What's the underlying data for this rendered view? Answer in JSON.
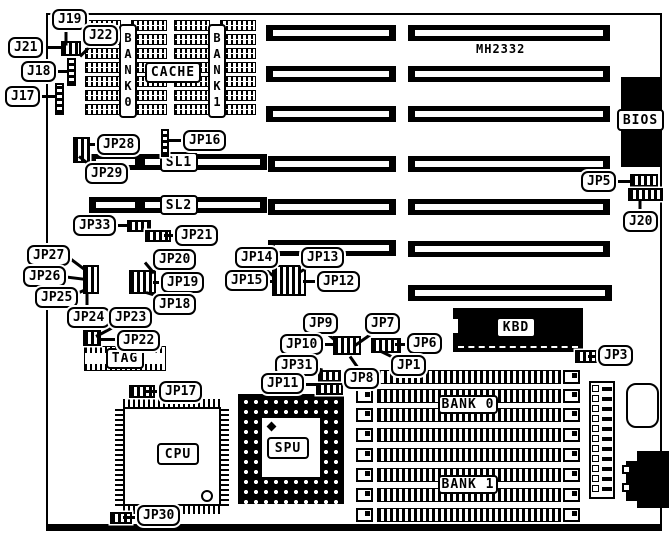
{
  "board_name": "MH2332",
  "chip_text": {
    "mh2332": "MH2332",
    "bios": "BIOS",
    "kbd": "KBD",
    "cpu": "CPU",
    "pga": "SPU",
    "tag": "TAG",
    "cache": "CACHE",
    "cache_bank0": "BANK0",
    "cache_bank1": "BANK1",
    "sl1": "SL1",
    "sl2": "SL2",
    "simm_bank0": "BANK 0",
    "simm_bank1": "BANK 1"
  },
  "callouts": [
    {
      "label": "J19",
      "x": 52,
      "y": 9,
      "tail": [
        66,
        28,
        16,
        90
      ]
    },
    {
      "label": "J21",
      "x": 8,
      "y": 37,
      "tail": [
        47,
        46,
        16,
        0
      ]
    },
    {
      "label": "J22",
      "x": 83,
      "y": 25,
      "tail": [
        90,
        45,
        14,
        135
      ]
    },
    {
      "label": "J18",
      "x": 21,
      "y": 61,
      "tail": [
        56,
        70,
        13,
        0
      ]
    },
    {
      "label": "J17",
      "x": 5,
      "y": 86,
      "tail": [
        42,
        95,
        15,
        0
      ]
    },
    {
      "label": "JP28",
      "x": 97,
      "y": 134,
      "tail": [
        88,
        143,
        11,
        0
      ]
    },
    {
      "label": "JP29",
      "x": 85,
      "y": 163,
      "tail": [
        79,
        155,
        13,
        38
      ]
    },
    {
      "label": "JP16",
      "x": 183,
      "y": 130,
      "tail": [
        168,
        139,
        16,
        0
      ]
    },
    {
      "label": "JP33",
      "x": 73,
      "y": 215,
      "tail": [
        110,
        224,
        18,
        0
      ]
    },
    {
      "label": "JP21",
      "x": 175,
      "y": 225,
      "tail": [
        164,
        234,
        12,
        0
      ]
    },
    {
      "label": "JP27",
      "x": 27,
      "y": 245,
      "tail": [
        66,
        254,
        23,
        37
      ]
    },
    {
      "label": "JP26",
      "x": 23,
      "y": 266,
      "tail": [
        62,
        275,
        23,
        7
      ]
    },
    {
      "label": "JP25",
      "x": 35,
      "y": 287,
      "tail": [
        72,
        294,
        16,
        -23
      ]
    },
    {
      "label": "JP24",
      "x": 67,
      "y": 307,
      "tail": [
        87,
        292,
        16,
        90
      ]
    },
    {
      "label": "JP23",
      "x": 109,
      "y": 307,
      "tail": [
        96,
        335,
        19,
        -28
      ]
    },
    {
      "label": "JP22",
      "x": 117,
      "y": 330,
      "tail": [
        99,
        338,
        19,
        0
      ]
    },
    {
      "label": "JP20",
      "x": 153,
      "y": 249,
      "tail": [
        145,
        261,
        14,
        50
      ]
    },
    {
      "label": "JP19",
      "x": 161,
      "y": 272,
      "tail": [
        153,
        281,
        9,
        0
      ]
    },
    {
      "label": "JP18",
      "x": 153,
      "y": 294,
      "tail": [
        146,
        291,
        13,
        17
      ]
    },
    {
      "label": "JP14",
      "x": 235,
      "y": 247,
      "tail": [
        262,
        265,
        15,
        40
      ]
    },
    {
      "label": "JP13",
      "x": 301,
      "y": 247,
      "tail": [
        299,
        271,
        15,
        -30
      ]
    },
    {
      "label": "JP15",
      "x": 225,
      "y": 270,
      "tail": [
        260,
        280,
        13,
        0
      ]
    },
    {
      "label": "JP12",
      "x": 317,
      "y": 271,
      "tail": [
        303,
        280,
        15,
        0
      ]
    },
    {
      "label": "JP9",
      "x": 303,
      "y": 313,
      "tail": [
        327,
        332,
        13,
        40
      ]
    },
    {
      "label": "JP7",
      "x": 365,
      "y": 313,
      "tail": [
        355,
        344,
        20,
        -35
      ]
    },
    {
      "label": "JP10",
      "x": 280,
      "y": 334,
      "tail": [
        318,
        343,
        16,
        0
      ]
    },
    {
      "label": "JP6",
      "x": 407,
      "y": 333,
      "tail": [
        395,
        343,
        13,
        0
      ]
    },
    {
      "label": "JP31",
      "x": 275,
      "y": 355,
      "tail": [
        308,
        365,
        15,
        14
      ]
    },
    {
      "label": "JP1",
      "x": 391,
      "y": 355,
      "tail": [
        379,
        349,
        15,
        26
      ]
    },
    {
      "label": "JP8",
      "x": 344,
      "y": 368,
      "tail": [
        350,
        355,
        15,
        55
      ]
    },
    {
      "label": "JP11",
      "x": 261,
      "y": 373,
      "tail": [
        301,
        383,
        16,
        0
      ]
    },
    {
      "label": "JP3",
      "x": 598,
      "y": 345,
      "tail": [
        588,
        355,
        11,
        0
      ]
    },
    {
      "label": "JP5",
      "x": 581,
      "y": 171,
      "tail": [
        613,
        180,
        18,
        0
      ]
    },
    {
      "label": "J20",
      "x": 623,
      "y": 211,
      "tail": [
        640,
        199,
        13,
        90
      ]
    },
    {
      "label": "JP17",
      "x": 159,
      "y": 381,
      "tail": [
        145,
        390,
        15,
        0
      ]
    },
    {
      "label": "JP30",
      "x": 137,
      "y": 505,
      "tail": [
        123,
        516,
        15,
        0
      ]
    }
  ],
  "jumpers": [
    [
      61,
      41,
      20,
      15,
      0,
      "j19"
    ],
    [
      67,
      58,
      9,
      28,
      1,
      "j18"
    ],
    [
      55,
      83,
      9,
      32,
      1,
      "j17"
    ],
    [
      73,
      137,
      17,
      26,
      0,
      "jp28"
    ],
    [
      161,
      129,
      8,
      28,
      1,
      "jp16"
    ],
    [
      127,
      220,
      24,
      12,
      0,
      "jp33"
    ],
    [
      145,
      230,
      26,
      12,
      0,
      "jp21"
    ],
    [
      83,
      265,
      16,
      29,
      0,
      "jp25-jp27"
    ],
    [
      83,
      330,
      18,
      16,
      0,
      "jp22"
    ],
    [
      129,
      270,
      27,
      24,
      0,
      "jp18-jp20"
    ],
    [
      272,
      265,
      34,
      31,
      0,
      "jp12-jp15"
    ],
    [
      333,
      336,
      28,
      19,
      0,
      "jp9-jp10"
    ],
    [
      371,
      338,
      30,
      15,
      0,
      "jp1-jp6"
    ],
    [
      318,
      370,
      23,
      12,
      0,
      "jp31"
    ],
    [
      316,
      383,
      27,
      12,
      0,
      "jp11"
    ],
    [
      575,
      350,
      23,
      13,
      0,
      "jp3"
    ],
    [
      630,
      174,
      28,
      13,
      0,
      "jp5"
    ],
    [
      628,
      188,
      35,
      13,
      0,
      "j20"
    ],
    [
      129,
      385,
      26,
      13,
      0,
      "jp17"
    ],
    [
      110,
      512,
      22,
      12,
      0,
      "jp30"
    ]
  ],
  "isa": {
    "left": [
      [
        266,
        25,
        130
      ],
      [
        266,
        66,
        130
      ],
      [
        266,
        106,
        130
      ],
      [
        268,
        156,
        128
      ],
      [
        268,
        199,
        128
      ],
      [
        268,
        240,
        128
      ]
    ],
    "right": [
      [
        408,
        25,
        202
      ],
      [
        408,
        66,
        202
      ],
      [
        408,
        106,
        202
      ],
      [
        408,
        156,
        202
      ],
      [
        408,
        199,
        202
      ],
      [
        408,
        241,
        202
      ],
      [
        408,
        285,
        204
      ]
    ],
    "sl": [
      [
        89,
        154,
        178
      ],
      [
        89,
        197,
        178
      ]
    ]
  },
  "simm": {
    "rows_y": [
      370,
      389,
      408,
      428,
      448,
      468,
      488,
      508
    ],
    "bracket_l_x": 356,
    "body_x": 377,
    "body_w": 184,
    "bracket_r_x": 563,
    "h": 14
  },
  "cache": {
    "bank_cols": [
      [
        85,
        131
      ],
      [
        174,
        220
      ]
    ],
    "rows": 7,
    "row_y0": 20,
    "row_gap": 14,
    "chip_w": 36,
    "chip_h": 11
  },
  "tag_chip": [
    84,
    346,
    82,
    25
  ],
  "power": {
    "pin_count": 11,
    "sq_x": 592,
    "pin_x": 602,
    "y0": 385,
    "step": 10
  }
}
